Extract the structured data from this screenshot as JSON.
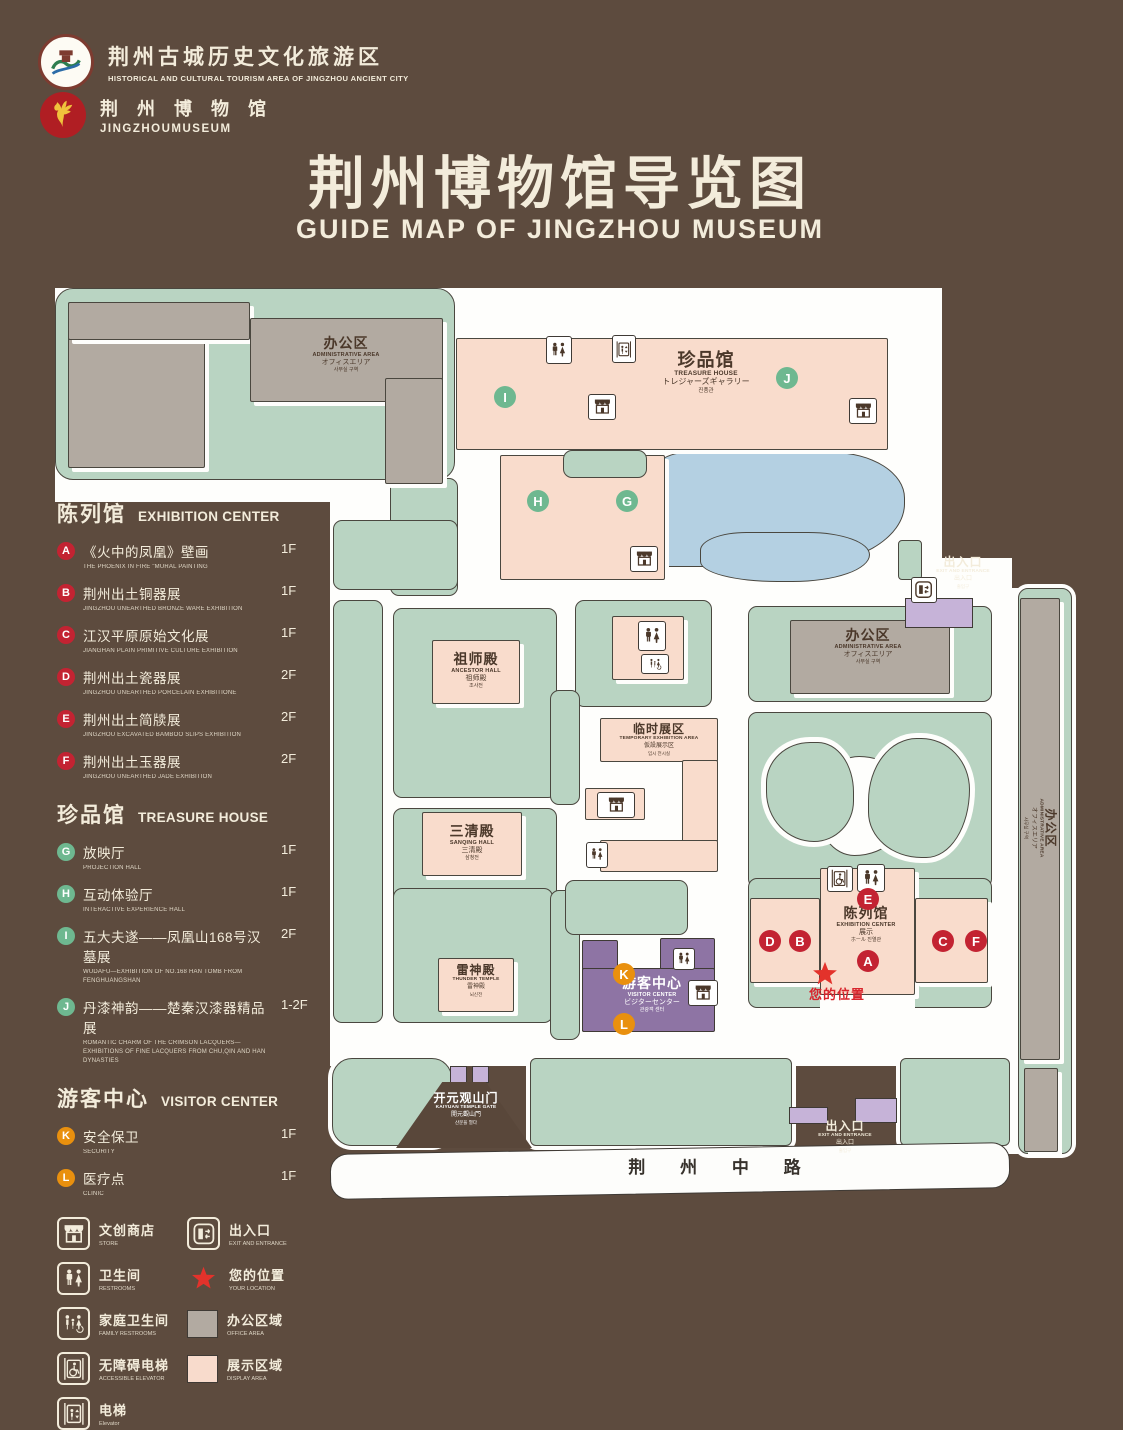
{
  "header": {
    "logo1_zh": "荆州古城历史文化旅游区",
    "logo1_en": "HISTORICAL AND CULTURAL TOURISM AREA OF JINGZHOU ANCIENT CITY",
    "logo2_zh": "荆 州 博 物 馆",
    "logo2_en": "JINGZHOUMUSEUM",
    "title_zh": "荆州博物馆导览图",
    "title_en": "GUIDE MAP OF JINGZHOU MUSEUM"
  },
  "colors": {
    "background": "#5d4b3e",
    "cream": "#f3ecdb",
    "plot_green": "#b9d4c2",
    "building_pink": "#f9dccc",
    "building_gray": "#b2aaa1",
    "lake_blue": "#b4d0e2",
    "visitor_purple": "#8e74a4",
    "gate_lilac": "#c6b3d8",
    "marker_red": "#c32332",
    "marker_green": "#6eb890",
    "marker_orange": "#e9900e",
    "location_red": "#e3322b"
  },
  "legend": {
    "sections": [
      {
        "zh": "陈列馆",
        "en": "EXHIBITION CENTER",
        "badge": "b-red",
        "items": [
          {
            "key": "A",
            "zh": "《火中的凤凰》壁画",
            "en": "THE PHOENIX IN FIRE \"MURAL PAINTING",
            "floor": "1F"
          },
          {
            "key": "B",
            "zh": "荆州出土铜器展",
            "en": "JINGZHOU UNEARTHED BRONZE WARE EXHIBITION",
            "floor": "1F"
          },
          {
            "key": "C",
            "zh": "江汉平原原始文化展",
            "en": "JIANGHAN PLAIN PRIMITIVE CULTURE EXHIBITION",
            "floor": "1F"
          },
          {
            "key": "D",
            "zh": "荆州出土瓷器展",
            "en": "JINGZHOU UNEARTHED PORCELAIN EXHIBITIONE",
            "floor": "2F"
          },
          {
            "key": "E",
            "zh": "荆州出土简牍展",
            "en": "JINGZHOU EXCAVATED BAMBOO SLIPS EXHIBITION",
            "floor": "2F"
          },
          {
            "key": "F",
            "zh": "荆州出土玉器展",
            "en": "JINGZHOU UNEARTHED JADE EXHIBITION",
            "floor": "2F"
          }
        ]
      },
      {
        "zh": "珍品馆",
        "en": "TREASURE HOUSE",
        "badge": "b-green",
        "items": [
          {
            "key": "G",
            "zh": "放映厅",
            "en": "PROJECTION HALL",
            "floor": "1F"
          },
          {
            "key": "H",
            "zh": "互动体验厅",
            "en": "INTERACTIVE EXPERIENCE HALL",
            "floor": "1F"
          },
          {
            "key": "I",
            "zh": "五大夫遂——凤凰山168号汉墓展",
            "en": "WUDAFU—EXHIBITION OF NO.168 HAN TOMB FROM FENGHUANGSHAN",
            "floor": "2F"
          },
          {
            "key": "J",
            "zh": "丹漆神韵——楚秦汉漆器精品展",
            "en": "ROMANTIC CHARM OF THE CRIMSON LACQUERS—EXHIBITIONS OF FINE LACQUERS FROM CHU,QIN AND HAN DYNASTIES",
            "floor": "1-2F"
          }
        ]
      },
      {
        "zh": "游客中心",
        "en": "VISITOR CENTER",
        "badge": "b-orange",
        "items": [
          {
            "key": "K",
            "zh": "安全保卫",
            "en": "SECURITY",
            "floor": "1F"
          },
          {
            "key": "L",
            "zh": "医疗点",
            "en": "CLINIC",
            "floor": "1F"
          }
        ]
      }
    ],
    "symbols": [
      {
        "icon": "store",
        "zh": "文创商店",
        "en": "STORE",
        "tile": "border"
      },
      {
        "icon": "exit",
        "zh": "出入口",
        "en": "EXIT AND ENTRANCE",
        "tile": "border"
      },
      {
        "icon": "restroom",
        "zh": "卫生间",
        "en": "RESTROOMS",
        "tile": "border"
      },
      {
        "icon": "star",
        "zh": "您的位置",
        "en": "YOUR LOCATION",
        "tile": "star"
      },
      {
        "icon": "family",
        "zh": "家庭卫生间",
        "en": "FAMILY RESTROOMS",
        "tile": "border"
      },
      {
        "icon": "office",
        "zh": "办公区域",
        "en": "OFFICE AREA",
        "tile": "sw-gray"
      },
      {
        "icon": "accessible",
        "zh": "无障碍电梯",
        "en": "ACCESSIBLE ELEVATOR",
        "tile": "border"
      },
      {
        "icon": "display",
        "zh": "展示区域",
        "en": "DISPLAY AREA",
        "tile": "sw-pink"
      },
      {
        "icon": "elevator",
        "zh": "电梯",
        "en": "Elevator",
        "tile": "border"
      }
    ]
  },
  "map": {
    "shapes": [
      {
        "n": "ground-top",
        "k": "white",
        "x": 55,
        "y": 288,
        "w": 400,
        "h": 214
      },
      {
        "n": "ground-main",
        "k": "white",
        "x": 330,
        "y": 288,
        "w": 612,
        "h": 285
      },
      {
        "n": "ground-mid",
        "k": "white",
        "x": 330,
        "y": 558,
        "w": 682,
        "h": 508
      },
      {
        "n": "ground-right-gap",
        "k": "white",
        "x": 1000,
        "y": 588,
        "w": 22,
        "h": 566
      },
      {
        "n": "plot-top-left",
        "k": "green",
        "x": 55,
        "y": 288,
        "w": 400,
        "h": 192,
        "r": 18
      },
      {
        "n": "plot-top-left-tail",
        "k": "green",
        "x": 390,
        "y": 478,
        "w": 68,
        "h": 118
      },
      {
        "n": "plot-mid-left-upper",
        "k": "green",
        "x": 333,
        "y": 520,
        "w": 125,
        "h": 70
      },
      {
        "n": "plot-left-column",
        "k": "green",
        "x": 333,
        "y": 600,
        "w": 50,
        "h": 423
      },
      {
        "n": "plot-ancestor",
        "k": "green",
        "x": 393,
        "y": 608,
        "w": 164,
        "h": 190
      },
      {
        "n": "plot-sanqing",
        "k": "green",
        "x": 393,
        "y": 808,
        "w": 164,
        "h": 106
      },
      {
        "n": "plot-thunder",
        "k": "green",
        "x": 393,
        "y": 888,
        "w": 160,
        "h": 135
      },
      {
        "n": "plot-temp-exhibit-top",
        "k": "green",
        "x": 575,
        "y": 600,
        "w": 137,
        "h": 107
      },
      {
        "n": "plot-temp-strip-a",
        "k": "green",
        "x": 550,
        "y": 690,
        "w": 30,
        "h": 115
      },
      {
        "n": "plot-temp-strip-b",
        "k": "green",
        "x": 550,
        "y": 890,
        "w": 30,
        "h": 150
      },
      {
        "n": "plot-temp-bottom",
        "k": "green",
        "x": 565,
        "y": 880,
        "w": 123,
        "h": 55
      },
      {
        "n": "plot-right-top",
        "k": "green",
        "x": 748,
        "y": 606,
        "w": 244,
        "h": 96
      },
      {
        "n": "garden-base",
        "k": "green",
        "x": 748,
        "y": 712,
        "w": 244,
        "h": 176
      },
      {
        "n": "plot-exhibition",
        "k": "green",
        "x": 748,
        "y": 878,
        "w": 244,
        "h": 130
      },
      {
        "n": "exhibition-white-notch",
        "k": "white",
        "x": 820,
        "y": 960,
        "w": 95,
        "h": 48
      },
      {
        "n": "garden-pond",
        "k": "pond",
        "x": 816,
        "y": 756,
        "w": 96,
        "h": 100,
        "br": "45% 55% 60% 40%/50% 45% 55% 50%"
      },
      {
        "n": "garden-island-left",
        "k": "island",
        "x": 766,
        "y": 742,
        "w": 88,
        "h": 100,
        "br": "55% 45% 50% 60%/45% 55% 45% 55%"
      },
      {
        "n": "garden-island-right",
        "k": "island",
        "x": 868,
        "y": 738,
        "w": 102,
        "h": 120,
        "br": "50% 50% 45% 55%/55% 45% 60% 40%"
      },
      {
        "n": "lake",
        "k": "lake",
        "x": 645,
        "y": 452,
        "w": 260,
        "h": 115,
        "br": "16% 28% 42% 8%/30% 40% 55% 20%"
      },
      {
        "n": "lake-lobe",
        "k": "lake",
        "x": 700,
        "y": 532,
        "w": 170,
        "h": 50,
        "br": "30% 40% 50% 50%/40% 50% 60% 45%"
      },
      {
        "n": "strip-bottom-left",
        "k": "green ring",
        "x": 332,
        "y": 1058,
        "w": 120,
        "h": 88,
        "r": 20
      },
      {
        "n": "strip-bottom-mid",
        "k": "green ring",
        "x": 530,
        "y": 1058,
        "w": 262,
        "h": 88,
        "r": 6
      },
      {
        "n": "strip-bottom-right",
        "k": "green ring",
        "x": 900,
        "y": 1058,
        "w": 110,
        "h": 88,
        "r": 6
      },
      {
        "n": "strip-right-vertical",
        "k": "green ring",
        "x": 1018,
        "y": 588,
        "w": 54,
        "h": 566,
        "r": 10
      },
      {
        "n": "exit-top-stub",
        "k": "green ring",
        "x": 898,
        "y": 540,
        "w": 24,
        "h": 40,
        "r": 4
      },
      {
        "n": "building-admin-tl-a",
        "k": "gray",
        "x": 68,
        "y": 302,
        "w": 137,
        "h": 166
      },
      {
        "n": "building-admin-tl-b",
        "k": "gray",
        "x": 68,
        "y": 302,
        "w": 182,
        "h": 38
      },
      {
        "n": "building-admin-tl-c",
        "k": "gray",
        "x": 250,
        "y": 318,
        "w": 193,
        "h": 84
      },
      {
        "n": "building-admin-tl-d",
        "k": "gray",
        "x": 385,
        "y": 378,
        "w": 58,
        "h": 106
      },
      {
        "n": "building-admin-right",
        "k": "gray",
        "x": 790,
        "y": 620,
        "w": 160,
        "h": 74
      },
      {
        "n": "building-admin-strip",
        "k": "gray",
        "x": 1020,
        "y": 598,
        "w": 40,
        "h": 462
      },
      {
        "n": "building-admin-strip-2",
        "k": "gray",
        "x": 1024,
        "y": 1068,
        "w": 34,
        "h": 84
      },
      {
        "n": "building-treasure-bar",
        "k": "pink",
        "x": 456,
        "y": 338,
        "w": 432,
        "h": 112
      },
      {
        "n": "building-treasure-block",
        "k": "pink",
        "x": 500,
        "y": 455,
        "w": 165,
        "h": 125
      },
      {
        "n": "plot-treasure-strip",
        "k": "green",
        "x": 563,
        "y": 450,
        "w": 84,
        "h": 28
      },
      {
        "n": "building-ancestor",
        "k": "pink",
        "x": 432,
        "y": 640,
        "w": 88,
        "h": 64
      },
      {
        "n": "building-sanqing",
        "k": "pink",
        "x": 422,
        "y": 812,
        "w": 100,
        "h": 64
      },
      {
        "n": "building-restrooms-mid",
        "k": "pink",
        "x": 612,
        "y": 616,
        "w": 72,
        "h": 64
      },
      {
        "n": "building-temp-top",
        "k": "pink",
        "x": 600,
        "y": 718,
        "w": 118,
        "h": 44
      },
      {
        "n": "building-temp-right",
        "k": "pink",
        "x": 682,
        "y": 760,
        "w": 36,
        "h": 82
      },
      {
        "n": "building-temp-bottom",
        "k": "pink",
        "x": 600,
        "y": 840,
        "w": 118,
        "h": 32
      },
      {
        "n": "building-temp-store",
        "k": "pink",
        "x": 585,
        "y": 788,
        "w": 60,
        "h": 32
      },
      {
        "n": "building-thunder",
        "k": "pink",
        "x": 438,
        "y": 958,
        "w": 76,
        "h": 54
      },
      {
        "n": "building-exhibition-left",
        "k": "pink",
        "x": 750,
        "y": 898,
        "w": 70,
        "h": 85
      },
      {
        "n": "building-exhibition-center",
        "k": "pink",
        "x": 820,
        "y": 868,
        "w": 95,
        "h": 127
      },
      {
        "n": "building-exhibition-right",
        "k": "pink",
        "x": 915,
        "y": 898,
        "w": 73,
        "h": 85
      },
      {
        "n": "building-visitor-left",
        "k": "purple",
        "x": 582,
        "y": 940,
        "w": 36,
        "h": 92
      },
      {
        "n": "building-visitor-top",
        "k": "purple",
        "x": 660,
        "y": 938,
        "w": 55,
        "h": 40
      },
      {
        "n": "building-visitor-main",
        "k": "purple",
        "x": 582,
        "y": 968,
        "w": 133,
        "h": 64
      },
      {
        "n": "gate-top-right",
        "k": "lilac",
        "x": 905,
        "y": 598,
        "w": 68,
        "h": 30
      },
      {
        "n": "gate-pillar-1",
        "k": "lilac",
        "x": 450,
        "y": 1066,
        "w": 17,
        "h": 17
      },
      {
        "n": "gate-pillar-2",
        "k": "lilac",
        "x": 472,
        "y": 1066,
        "w": 17,
        "h": 17
      },
      {
        "n": "gate-bottom-right-1",
        "k": "lilac",
        "x": 789,
        "y": 1107,
        "w": 39,
        "h": 17
      },
      {
        "n": "gate-bottom-right-2",
        "k": "lilac",
        "x": 855,
        "y": 1098,
        "w": 42,
        "h": 25
      },
      {
        "n": "kaiyuan-gate-wall",
        "k": "gatewall",
        "x": 396,
        "y": 1082,
        "w": 136,
        "h": 66,
        "clip": "polygon(34% 0,66% 0,100% 100%,0 100%)"
      },
      {
        "n": "road",
        "k": "road",
        "x": 330,
        "y": 1148,
        "w": 680,
        "h": 46,
        "rot": -1
      }
    ],
    "labels": [
      {
        "id": "admin-top-left",
        "x": 346,
        "y": 336,
        "zh": "办公区",
        "en": "ADMINISTRATIVE AREA",
        "jp": "オフィスエリア",
        "kr": "사무실 구역"
      },
      {
        "id": "treasure-house",
        "x": 706,
        "y": 350,
        "v": "lg",
        "zh": "珍品馆",
        "en": "TREASURE HOUSE",
        "jp": "トレジャーズギャラリー",
        "kr": "진품관"
      },
      {
        "id": "ancestor-hall",
        "x": 476,
        "y": 652,
        "zh": "祖师殿",
        "en": "ANCESTOR HALL",
        "jp": "祖师殿",
        "kr": "조사전"
      },
      {
        "id": "sanqing-hall",
        "x": 472,
        "y": 824,
        "zh": "三清殿",
        "en": "SANQING HALL",
        "jp": "三清殿",
        "kr": "삼청전"
      },
      {
        "id": "temporary-exhibition",
        "x": 659,
        "y": 723,
        "v": "sm",
        "zh": "临时展区",
        "en": "TEMPORARY EXHIBITION AREA",
        "jp": "仮設展示区",
        "kr": "임시 전시실"
      },
      {
        "id": "admin-right",
        "x": 868,
        "y": 628,
        "zh": "办公区",
        "en": "ADMINISTRATIVE AREA",
        "jp": "オフィスエリア",
        "kr": "사무실 구역"
      },
      {
        "id": "admin-strip",
        "x": 1040,
        "y": 828,
        "v": "sm rot",
        "zh": "办公区",
        "en": "ADMINISTRATIVE AREA",
        "jp": "オフィスエリア",
        "kr": "사무실 구역"
      },
      {
        "id": "exhibition-center",
        "x": 866,
        "y": 906,
        "zh": "陈列馆",
        "en": "EXHIBITION CENTER",
        "jp": "展示",
        "kr": "ホール 진열관"
      },
      {
        "id": "thunder-temple",
        "x": 476,
        "y": 964,
        "v": "sm",
        "zh": "雷神殿",
        "en": "THUNDER TEMPLE",
        "jp": "雷神殿",
        "kr": "뇌신전"
      },
      {
        "id": "visitor-center",
        "x": 652,
        "y": 976,
        "v": "light",
        "zh": "游客中心",
        "en": "VISITOR CENTER",
        "jp": "ビジターセンター",
        "kr": "관광객 센터"
      },
      {
        "id": "kaiyuan-gate",
        "x": 466,
        "y": 1092,
        "v": "sm light",
        "zh": "开元观山门",
        "en": "KAIYUAN TEMPLE GATE",
        "jp": "開元觀山門",
        "kr": "산문을 열다"
      },
      {
        "id": "exit-top-right",
        "x": 963,
        "y": 556,
        "v": "sm cream",
        "zh": "出入口",
        "en": "EXIT AND ENTRANCE",
        "jp": "出入口",
        "kr": "출입구"
      },
      {
        "id": "exit-bottom-right",
        "x": 845,
        "y": 1120,
        "v": "sm cream",
        "zh": "出入口",
        "en": "EXIT AND ENTRANCE",
        "jp": "出入口",
        "kr": "출입구"
      },
      {
        "id": "road-name",
        "x": 722,
        "y": 1158,
        "v": "roadlbl",
        "zh": "荆 州 中 路"
      },
      {
        "id": "your-location",
        "x": 837,
        "y": 988,
        "v": "red",
        "zh": "您的位置"
      }
    ],
    "markers": [
      {
        "letter": "I",
        "c": "m-green",
        "x": 505,
        "y": 397
      },
      {
        "letter": "J",
        "c": "m-green",
        "x": 787,
        "y": 378
      },
      {
        "letter": "H",
        "c": "m-green",
        "x": 538,
        "y": 501
      },
      {
        "letter": "G",
        "c": "m-green",
        "x": 627,
        "y": 501
      },
      {
        "letter": "E",
        "c": "m-red",
        "x": 868,
        "y": 899
      },
      {
        "letter": "D",
        "c": "m-red",
        "x": 770,
        "y": 941
      },
      {
        "letter": "B",
        "c": "m-red",
        "x": 800,
        "y": 941
      },
      {
        "letter": "C",
        "c": "m-red",
        "x": 943,
        "y": 941
      },
      {
        "letter": "F",
        "c": "m-red",
        "x": 976,
        "y": 941
      },
      {
        "letter": "A",
        "c": "m-red",
        "x": 868,
        "y": 961
      },
      {
        "letter": "K",
        "c": "m-orange",
        "x": 624,
        "y": 974
      },
      {
        "letter": "L",
        "c": "m-orange",
        "x": 624,
        "y": 1024
      }
    ],
    "icons": [
      {
        "t": "restroom",
        "x": 546,
        "y": 336,
        "w": 26,
        "h": 28
      },
      {
        "t": "elevator",
        "x": 612,
        "y": 335,
        "w": 24,
        "h": 28
      },
      {
        "t": "store",
        "x": 588,
        "y": 394,
        "w": 28,
        "h": 26
      },
      {
        "t": "store",
        "x": 849,
        "y": 398,
        "w": 28,
        "h": 26
      },
      {
        "t": "store",
        "x": 630,
        "y": 546,
        "w": 28,
        "h": 26
      },
      {
        "t": "restroom",
        "x": 638,
        "y": 621,
        "w": 28,
        "h": 30
      },
      {
        "t": "family",
        "x": 641,
        "y": 654,
        "w": 28,
        "h": 20
      },
      {
        "t": "store",
        "x": 597,
        "y": 792,
        "w": 38,
        "h": 26
      },
      {
        "t": "restroom",
        "x": 586,
        "y": 842,
        "w": 22,
        "h": 26
      },
      {
        "t": "accessible",
        "x": 827,
        "y": 866,
        "w": 26,
        "h": 26
      },
      {
        "t": "restroom",
        "x": 857,
        "y": 864,
        "w": 28,
        "h": 28
      },
      {
        "t": "restroom",
        "x": 673,
        "y": 948,
        "w": 22,
        "h": 22
      },
      {
        "t": "store",
        "x": 688,
        "y": 980,
        "w": 30,
        "h": 26
      },
      {
        "t": "exit",
        "x": 911,
        "y": 577,
        "w": 26,
        "h": 26
      },
      {
        "t": "star",
        "x": 811,
        "y": 960,
        "w": 28,
        "h": 28
      }
    ]
  }
}
